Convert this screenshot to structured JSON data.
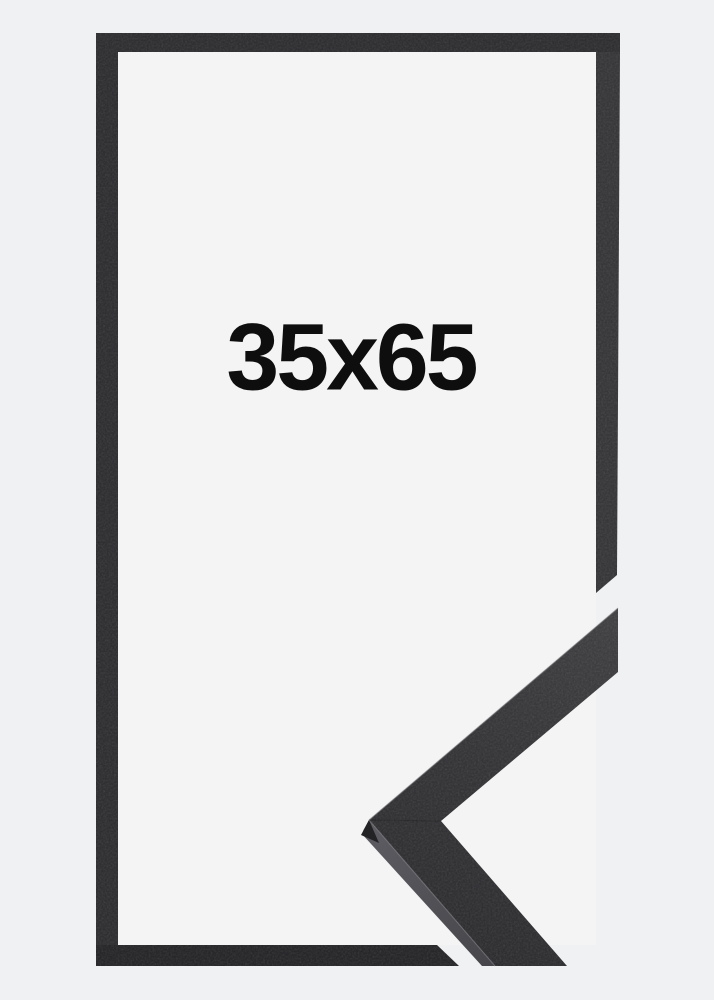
{
  "label": {
    "text": "35x65"
  },
  "colors": {
    "background": "#f0f1f3",
    "inner_area": "#f4f4f5",
    "frame_top": "#2f2f32",
    "frame_left": "#2f2f32",
    "frame_right": "#37373a",
    "frame_bottom": "#27272a",
    "sample_face": "#38383b",
    "sample_side": "#53535a",
    "label_text": "#0e0e0f"
  }
}
